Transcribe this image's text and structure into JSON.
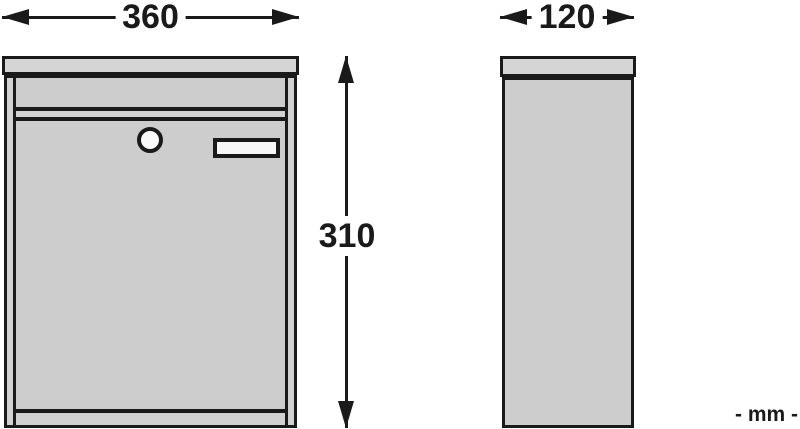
{
  "drawing": {
    "title": "mailbox-dimension-drawing",
    "dimensions": {
      "front_width": "360",
      "front_height": "310",
      "side_depth": "120"
    },
    "unit_note": "- mm -",
    "colors": {
      "ink": "#1a1a1a",
      "background": "#ffffff",
      "lid_fill": "#d5d5d5",
      "body_fill": "#d1d1d1",
      "panel_fill": "#cdcdcd",
      "plate_fill": "#f7f7f7",
      "lock_fill": "#fafafa"
    }
  }
}
